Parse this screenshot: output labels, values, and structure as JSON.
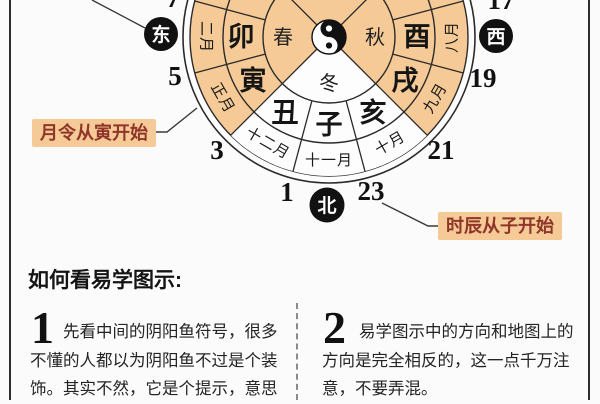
{
  "diagram": {
    "directions": {
      "east": "东",
      "west": "西",
      "north": "北"
    },
    "seasons": {
      "spring": "春",
      "autumn": "秋",
      "winter": "冬"
    },
    "branches": {
      "mao": "卯",
      "yin": "寅",
      "chou": "丑",
      "zi": "子",
      "hai": "亥",
      "xu": "戌",
      "you": "酉"
    },
    "months": {
      "feb": "二月",
      "jan": "正月",
      "dec": "十二月",
      "nov": "十一月",
      "oct": "十月",
      "sep": "九月",
      "aug": "八月"
    },
    "hours": {
      "h7": "7",
      "h5": "5",
      "h3": "3",
      "h1": "1",
      "h23": "23",
      "h21": "21",
      "h19": "19",
      "h17": "17"
    },
    "callouts": {
      "month_start": "月令从寅开始",
      "hour_start": "时辰从子开始"
    },
    "colors": {
      "sector_tan": "#f5ca96",
      "callout_text": "#8f352a",
      "badge_black": "#111111"
    }
  },
  "guide": {
    "heading": "如何看易学图示:",
    "items": [
      {
        "number": "1",
        "text": "先看中间的阴阳鱼符号，很多不懂的人都以为阴阳鱼不过是个装饰。其实不然，它是个提示，意思"
      },
      {
        "number": "2",
        "text": "易学图示中的方向和地图上的方向是完全相反的，这一点千万注意，不要弄混。"
      }
    ]
  }
}
